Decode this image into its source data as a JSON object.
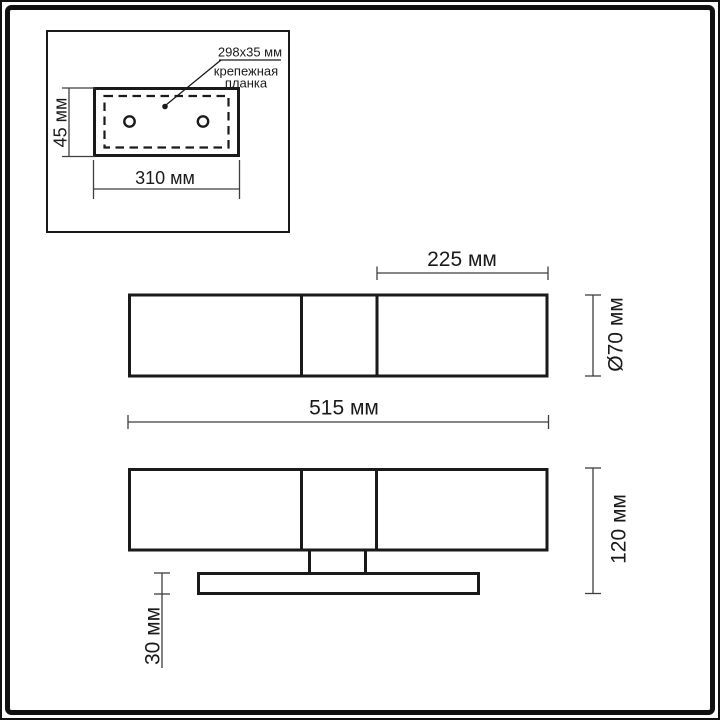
{
  "drawing": {
    "kind": "wall-lamp-dimension-drawing"
  },
  "inset_top_view": {
    "callout": {
      "size": "298x35 мм",
      "name_line1": "крепежная",
      "name_line2": "планка"
    },
    "height_dim": "45 мм",
    "width_dim": "310 мм"
  },
  "front_view": {
    "shade_width_dim": "225 мм",
    "diameter_dim": "Ø70 мм",
    "total_width_dim": "515 мм"
  },
  "side_view": {
    "total_height_dim": "120 мм",
    "backplate_height_dim": "30 мм"
  },
  "colors": {
    "object_line": "#1a1a1a",
    "dimension_line": "#3e3e3e",
    "frame": "#111111",
    "background": "#ffffff"
  }
}
